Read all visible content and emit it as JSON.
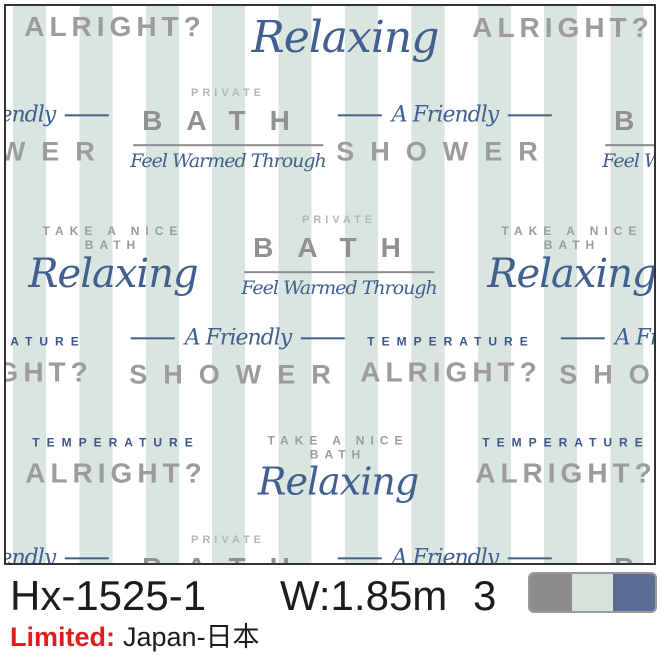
{
  "pattern": {
    "texts": {
      "alright": "ALRIGHT?",
      "relaxing": "Relaxing",
      "private": "PRIVATE",
      "bath": "BATH",
      "feel": "Feel Warmed Through",
      "friendly": "A Friendly",
      "shower": "SHOWER",
      "take": "TAKE A NICE",
      "take_bath": "BATH",
      "temperature": "TEMPERATURE"
    },
    "colors": {
      "stripe_mint": "#d9e5de",
      "background": "#ffffff",
      "gray_text": "#9c9c9c",
      "light_gray_text": "#b4b7b7",
      "script_blue": "#41608f",
      "navy_text": "#3b568c",
      "border": "#333333"
    },
    "elements": [
      {
        "type": "alright",
        "x": 115,
        "y": 27
      },
      {
        "type": "relaxing",
        "x": 345,
        "y": 38,
        "size": 44
      },
      {
        "type": "alright",
        "x": 563,
        "y": 28
      },
      {
        "type": "friendly-shower",
        "x": 2,
        "y": 135
      },
      {
        "type": "bath-block",
        "x": 228,
        "y": 130
      },
      {
        "type": "friendly-shower",
        "x": 445,
        "y": 135
      },
      {
        "type": "bath-block",
        "x": 700,
        "y": 130
      },
      {
        "type": "take-relax",
        "x": 113,
        "y": 260,
        "size": 40
      },
      {
        "type": "bath-block",
        "x": 339,
        "y": 257
      },
      {
        "type": "take-relax",
        "x": 572,
        "y": 260,
        "size": 40
      },
      {
        "type": "temp-alright",
        "x": 2,
        "y": 362
      },
      {
        "type": "friendly-shower",
        "x": 238,
        "y": 358
      },
      {
        "type": "temp-alright",
        "x": 451,
        "y": 362
      },
      {
        "type": "friendly-shower",
        "x": 668,
        "y": 358
      },
      {
        "type": "temp-alright",
        "x": 116,
        "y": 463
      },
      {
        "type": "take-relax",
        "x": 338,
        "y": 468,
        "size": 38
      },
      {
        "type": "temp-alright",
        "x": 566,
        "y": 463
      },
      {
        "type": "friendly-shower",
        "x": 2,
        "y": 578
      },
      {
        "type": "bath-block",
        "x": 228,
        "y": 577
      },
      {
        "type": "friendly-shower",
        "x": 445,
        "y": 578
      },
      {
        "type": "bath-block",
        "x": 700,
        "y": 577
      }
    ]
  },
  "caption": {
    "code": "Hx-1525-1",
    "width_label": "W:1.85m",
    "quantity": "3",
    "limited_label": "Limited:",
    "region": "Japan-日本",
    "text_color": "#1c1c1c",
    "limited_color": "#e11d1d",
    "swatches": [
      {
        "name": "gray",
        "color": "#8b8d8e"
      },
      {
        "name": "mint",
        "color": "#d6e3db"
      },
      {
        "name": "blue",
        "color": "#5a6b94"
      }
    ]
  }
}
